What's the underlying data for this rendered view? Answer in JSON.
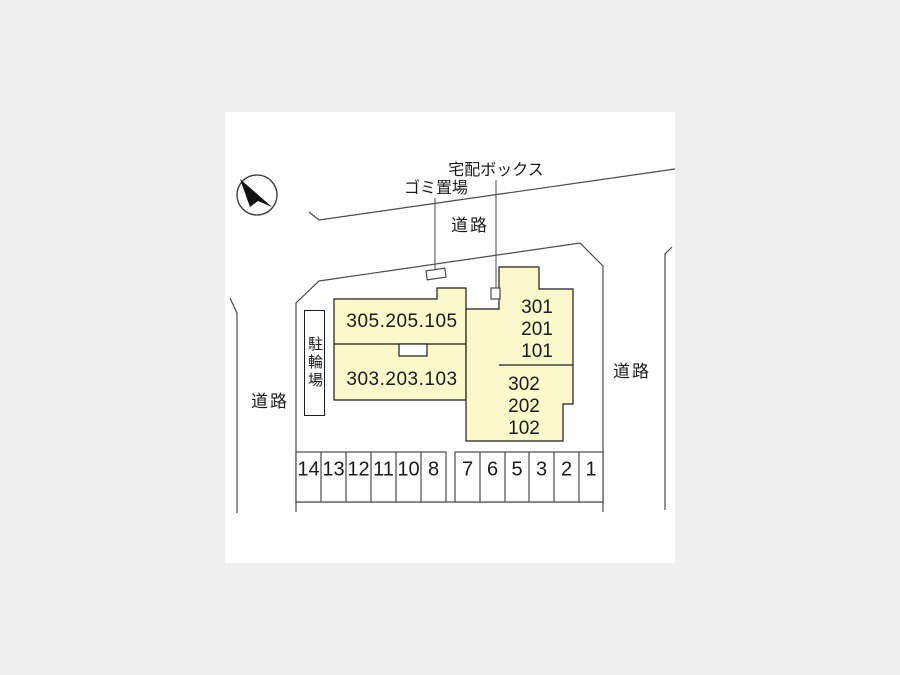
{
  "colors": {
    "outer_background": "#efefef",
    "plan_background": "#ffffff",
    "building_fill": "#fbf8cc",
    "building_outline": "#1c1c1c",
    "boundary_line": "#4a4a4a"
  },
  "labels": {
    "delivery_box": "宅配ボックス",
    "garbage_area": "ゴミ置場",
    "road_top": "道路",
    "road_left": "道路",
    "road_right": "道路",
    "bicycle_parking": "駐輪場"
  },
  "buildings": {
    "west_upper_units": "305.205.105",
    "west_lower_units": "303.203.103",
    "east_upper_units": [
      "301",
      "201",
      "101"
    ],
    "east_lower_units": [
      "302",
      "202",
      "102"
    ]
  },
  "parking": {
    "left_spaces": [
      "14",
      "13",
      "12",
      "11",
      "10",
      "8"
    ],
    "right_spaces": [
      "7",
      "6",
      "5",
      "3",
      "2",
      "1"
    ]
  },
  "icons": {
    "north_arrow": "north-arrow-icon"
  }
}
